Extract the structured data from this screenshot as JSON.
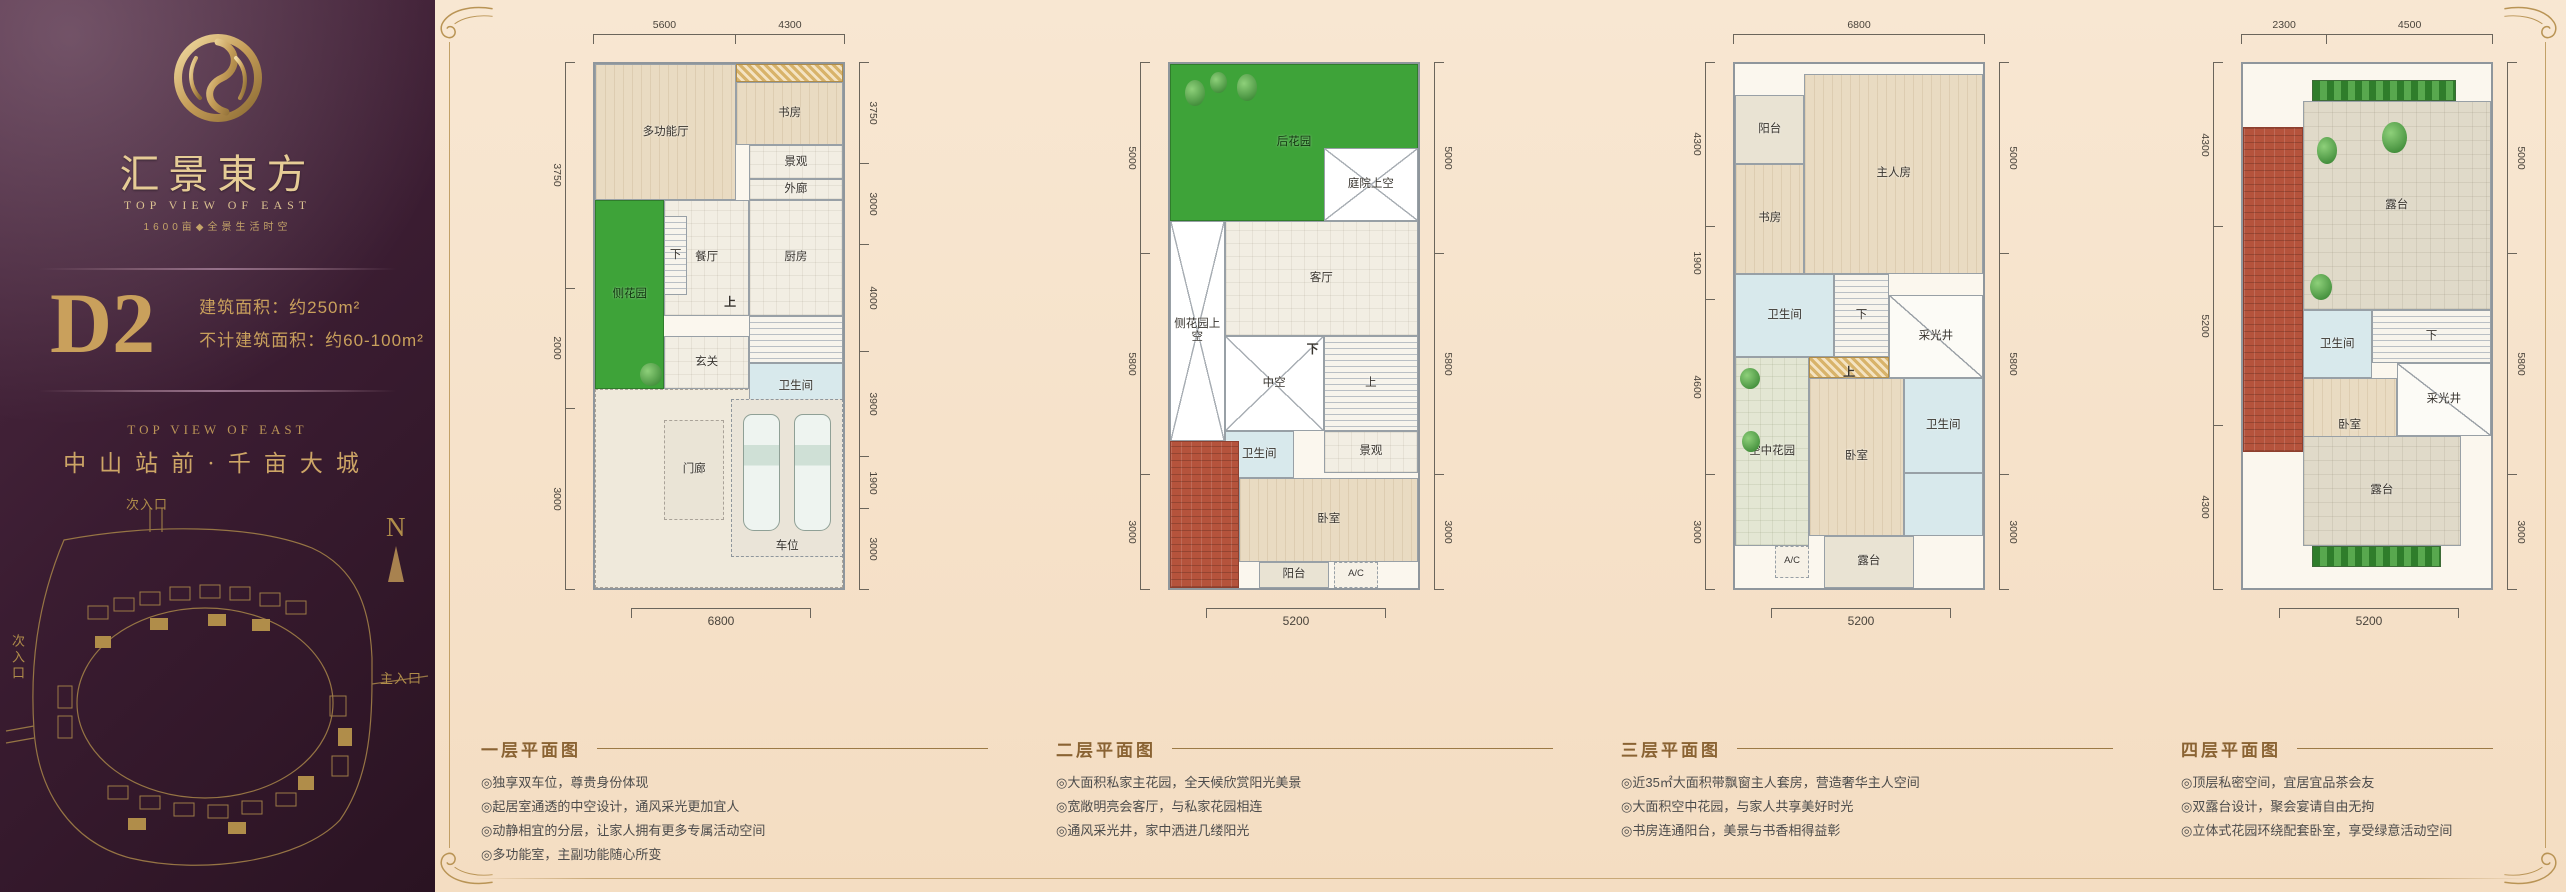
{
  "sidebar": {
    "brand_cn": "汇景東方",
    "brand_en": "TOP VIEW OF EAST",
    "tagline": "1600亩◆全景生活时空",
    "unit_code": "D2",
    "unit_area_1": "建筑面积：约250m²",
    "unit_area_2": "不计建筑面积：约60-100m²",
    "slogan_en": "TOP VIEW OF EAST",
    "slogan_cn": "中山站前·千亩大城",
    "map": {
      "north_label": "N",
      "entry_top": "次入口",
      "entry_left": "次入口",
      "entry_main": "主入口"
    }
  },
  "colors": {
    "gold": "#b99455",
    "purple": "#3a1c31",
    "cream": "#f6e2ca",
    "caption_title": "#8a6333",
    "roof_red": "#b5533c",
    "garden_green": "#3ea339"
  },
  "plans": [
    {
      "title": "一层平面图",
      "dims": {
        "top": [
          "5600",
          "4300"
        ],
        "left": [
          "3750",
          "2000",
          "3000"
        ],
        "right": [
          "3750",
          "3000",
          "4000",
          "3900",
          "1900",
          "3000"
        ],
        "bottom": [
          "6800"
        ]
      },
      "rooms": [
        {
          "name": "front-yard",
          "label": "",
          "type": "yard",
          "x": 0,
          "y": 62,
          "w": 100,
          "h": 38
        },
        {
          "name": "multi-function-hall",
          "label": "多功能厅",
          "type": "wood",
          "x": 0,
          "y": 0,
          "w": 57,
          "h": 26
        },
        {
          "name": "trellis",
          "label": "",
          "type": "closet",
          "x": 57,
          "y": 0,
          "w": 43,
          "h": 3.5
        },
        {
          "name": "study",
          "label": "书房",
          "type": "wood",
          "x": 57,
          "y": 3.5,
          "w": 43,
          "h": 12
        },
        {
          "name": "landscape",
          "label": "景观",
          "type": "tile",
          "x": 62,
          "y": 15.5,
          "w": 38,
          "h": 6.5
        },
        {
          "name": "outer-corridor",
          "label": "外廊",
          "type": "tile",
          "x": 62,
          "y": 22,
          "w": 38,
          "h": 4
        },
        {
          "name": "side-garden",
          "label": "侧花园",
          "type": "garden",
          "x": 0,
          "y": 26,
          "w": 28,
          "h": 36
        },
        {
          "name": "dining-room",
          "label": "餐厅",
          "type": "tile",
          "x": 28,
          "y": 26,
          "w": 34,
          "h": 22
        },
        {
          "name": "kitchen",
          "label": "厨房",
          "type": "tile",
          "x": 62,
          "y": 26,
          "w": 38,
          "h": 22
        },
        {
          "name": "stair-down",
          "label": "下",
          "type": "stair",
          "x": 28,
          "y": 29,
          "w": 9,
          "h": 15
        },
        {
          "name": "stairwell",
          "label": "",
          "type": "stair",
          "x": 62,
          "y": 48,
          "w": 38,
          "h": 9
        },
        {
          "name": "up-label",
          "label": "上",
          "type": "plain",
          "x": 50,
          "y": 43,
          "w": 9,
          "h": 5
        },
        {
          "name": "foyer",
          "label": "玄关",
          "type": "tile",
          "x": 28,
          "y": 52,
          "w": 34,
          "h": 10
        },
        {
          "name": "bathroom",
          "label": "卫生间",
          "type": "bath",
          "x": 62,
          "y": 57,
          "w": 38,
          "h": 9
        },
        {
          "name": "tree",
          "label": "",
          "type": "tree",
          "x": 18,
          "y": 57,
          "w": 9,
          "h": 4.5
        },
        {
          "name": "porch",
          "label": "门廊",
          "type": "porch",
          "x": 28,
          "y": 68,
          "w": 24,
          "h": 19
        },
        {
          "name": "parking",
          "label": "车位",
          "type": "parking",
          "x": 55,
          "y": 64,
          "w": 45,
          "h": 30
        }
      ],
      "bullets": [
        "◎独享双车位，尊贵身份体现",
        "◎起居室通透的中空设计，通风采光更加宜人",
        "◎动静相宜的分层，让家人拥有更多专属活动空间",
        "◎多功能室，主副功能随心所变"
      ]
    },
    {
      "title": "二层平面图",
      "dims": {
        "left": [
          "5000",
          "5800",
          "3000"
        ],
        "right": [
          "5000",
          "5800",
          "3000"
        ],
        "bottom": [
          "5200"
        ]
      },
      "rooms": [
        {
          "name": "back-garden",
          "label": "后花园",
          "type": "garden",
          "x": 0,
          "y": 0,
          "w": 100,
          "h": 30
        },
        {
          "name": "tree",
          "label": "",
          "type": "tree",
          "x": 6,
          "y": 3,
          "w": 8,
          "h": 5
        },
        {
          "name": "tree",
          "label": "",
          "type": "tree",
          "x": 16,
          "y": 1.5,
          "w": 7,
          "h": 4
        },
        {
          "name": "tree",
          "label": "",
          "type": "tree",
          "x": 27,
          "y": 2,
          "w": 8,
          "h": 5
        },
        {
          "name": "courtyard-void",
          "label": "庭院上空",
          "type": "void",
          "x": 62,
          "y": 16,
          "w": 38,
          "h": 14
        },
        {
          "name": "side-garden-void",
          "label": "侧花园上空",
          "type": "void",
          "x": 0,
          "y": 30,
          "w": 22,
          "h": 42
        },
        {
          "name": "living-room",
          "label": "客厅",
          "type": "tile",
          "x": 22,
          "y": 30,
          "w": 78,
          "h": 22
        },
        {
          "name": "atrium-void",
          "label": "中空",
          "type": "void",
          "x": 22,
          "y": 52,
          "w": 40,
          "h": 18
        },
        {
          "name": "stairwell",
          "label": "上",
          "type": "stair",
          "x": 62,
          "y": 52,
          "w": 38,
          "h": 18
        },
        {
          "name": "down-label",
          "label": "下",
          "type": "plain",
          "x": 53,
          "y": 52,
          "w": 9,
          "h": 5
        },
        {
          "name": "bathroom",
          "label": "卫生间",
          "type": "bath",
          "x": 22,
          "y": 70,
          "w": 28,
          "h": 9
        },
        {
          "name": "landscape",
          "label": "景观",
          "type": "tile",
          "x": 62,
          "y": 70,
          "w": 38,
          "h": 8
        },
        {
          "name": "roof",
          "label": "",
          "type": "roof",
          "x": 0,
          "y": 72,
          "w": 28,
          "h": 28
        },
        {
          "name": "bedroom",
          "label": "卧室",
          "type": "wood",
          "x": 28,
          "y": 79,
          "w": 72,
          "h": 16
        },
        {
          "name": "balcony",
          "label": "阳台",
          "type": "balcony",
          "x": 36,
          "y": 95,
          "w": 28,
          "h": 5
        },
        {
          "name": "ac-unit",
          "label": "A/C",
          "type": "ac",
          "x": 66,
          "y": 95,
          "w": 18,
          "h": 5
        }
      ],
      "bullets": [
        "◎大面积私家主花园，全天候欣赏阳光美景",
        "◎宽敞明亮会客厅，与私家花园相连",
        "◎通风采光井，家中洒进几缕阳光"
      ]
    },
    {
      "title": "三层平面图",
      "dims": {
        "top": [
          "6800"
        ],
        "left": [
          "4300",
          "1900",
          "4600",
          "3000"
        ],
        "right": [
          "5000",
          "5800",
          "3000"
        ],
        "bottom": [
          "5200"
        ]
      },
      "rooms": [
        {
          "name": "balcony",
          "label": "阳台",
          "type": "balcony",
          "x": 0,
          "y": 6,
          "w": 28,
          "h": 13
        },
        {
          "name": "master-bedroom",
          "label": "主人房",
          "type": "wood",
          "x": 28,
          "y": 2,
          "w": 72,
          "h": 38
        },
        {
          "name": "study",
          "label": "书房",
          "type": "wood",
          "x": 0,
          "y": 19,
          "w": 28,
          "h": 21
        },
        {
          "name": "bathroom-upper",
          "label": "卫生间",
          "type": "bath",
          "x": 0,
          "y": 40,
          "w": 40,
          "h": 16
        },
        {
          "name": "closet",
          "label": "",
          "type": "closet",
          "x": 30,
          "y": 56,
          "w": 32,
          "h": 4
        },
        {
          "name": "stairwell",
          "label": "下",
          "type": "stair",
          "x": 40,
          "y": 40,
          "w": 22,
          "h": 16
        },
        {
          "name": "lightwell",
          "label": "采光井",
          "type": "lightwell",
          "x": 62,
          "y": 44,
          "w": 38,
          "h": 16
        },
        {
          "name": "sky-garden",
          "label": "空中花园",
          "type": "skygarden",
          "x": 0,
          "y": 56,
          "w": 30,
          "h": 36
        },
        {
          "name": "tree",
          "label": "",
          "type": "tree",
          "x": 2,
          "y": 58,
          "w": 8,
          "h": 4
        },
        {
          "name": "tree",
          "label": "",
          "type": "tree",
          "x": 3,
          "y": 70,
          "w": 7,
          "h": 4
        },
        {
          "name": "bedroom",
          "label": "卧室",
          "type": "wood",
          "x": 30,
          "y": 60,
          "w": 38,
          "h": 30
        },
        {
          "name": "bathroom-lower",
          "label": "卫生间",
          "type": "bath",
          "x": 68,
          "y": 60,
          "w": 32,
          "h": 18
        },
        {
          "name": "shower",
          "label": "",
          "type": "bath",
          "x": 68,
          "y": 78,
          "w": 32,
          "h": 12
        },
        {
          "name": "up-label",
          "label": "上",
          "type": "plain",
          "x": 42,
          "y": 57,
          "w": 8,
          "h": 4
        },
        {
          "name": "ac-unit",
          "label": "A/C",
          "type": "ac",
          "x": 16,
          "y": 92,
          "w": 14,
          "h": 6
        },
        {
          "name": "terrace",
          "label": "露台",
          "type": "balcony",
          "x": 36,
          "y": 90,
          "w": 36,
          "h": 10
        }
      ],
      "bullets": [
        "◎近35㎡大面积带飘窗主人套房，营造奢华主人空间",
        "◎大面积空中花园，与家人共享美好时光",
        "◎书房连通阳台，美景与书香相得益彰"
      ]
    },
    {
      "title": "四层平面图",
      "dims": {
        "top": [
          "2300",
          "4500"
        ],
        "left": [
          "4300",
          "5200",
          "4300"
        ],
        "right": [
          "5000",
          "5800",
          "3000"
        ],
        "bottom": [
          "5200"
        ]
      },
      "rooms": [
        {
          "name": "hedge-top",
          "label": "",
          "type": "planter",
          "x": 28,
          "y": 3,
          "w": 58,
          "h": 4
        },
        {
          "name": "terrace-top",
          "label": "露台",
          "type": "terrace",
          "x": 24,
          "y": 7,
          "w": 76,
          "h": 40
        },
        {
          "name": "roof",
          "label": "",
          "type": "roof",
          "x": 0,
          "y": 12,
          "w": 24,
          "h": 62
        },
        {
          "name": "tree",
          "label": "",
          "type": "tree",
          "x": 56,
          "y": 11,
          "w": 10,
          "h": 6
        },
        {
          "name": "tree",
          "label": "",
          "type": "tree",
          "x": 30,
          "y": 14,
          "w": 8,
          "h": 5
        },
        {
          "name": "tree",
          "label": "",
          "type": "tree",
          "x": 27,
          "y": 40,
          "w": 9,
          "h": 5
        },
        {
          "name": "bathroom",
          "label": "卫生间",
          "type": "bath",
          "x": 24,
          "y": 47,
          "w": 28,
          "h": 13
        },
        {
          "name": "stairwell",
          "label": "下",
          "type": "stair",
          "x": 52,
          "y": 47,
          "w": 48,
          "h": 10
        },
        {
          "name": "lightwell",
          "label": "采光井",
          "type": "lightwell",
          "x": 62,
          "y": 57,
          "w": 38,
          "h": 14
        },
        {
          "name": "bedroom",
          "label": "卧室",
          "type": "wood",
          "x": 24,
          "y": 60,
          "w": 38,
          "h": 18
        },
        {
          "name": "terrace-bottom",
          "label": "露台",
          "type": "terrace",
          "x": 24,
          "y": 71,
          "w": 64,
          "h": 21
        },
        {
          "name": "hedge-bottom",
          "label": "",
          "type": "planter",
          "x": 28,
          "y": 92,
          "w": 52,
          "h": 4
        }
      ],
      "bullets": [
        "◎顶层私密空间，宜居宜品茶会友",
        "◎双露台设计，聚会宴请自由无拘",
        "◎立体式花园环绕配套卧室，享受绿意活动空间"
      ]
    }
  ]
}
